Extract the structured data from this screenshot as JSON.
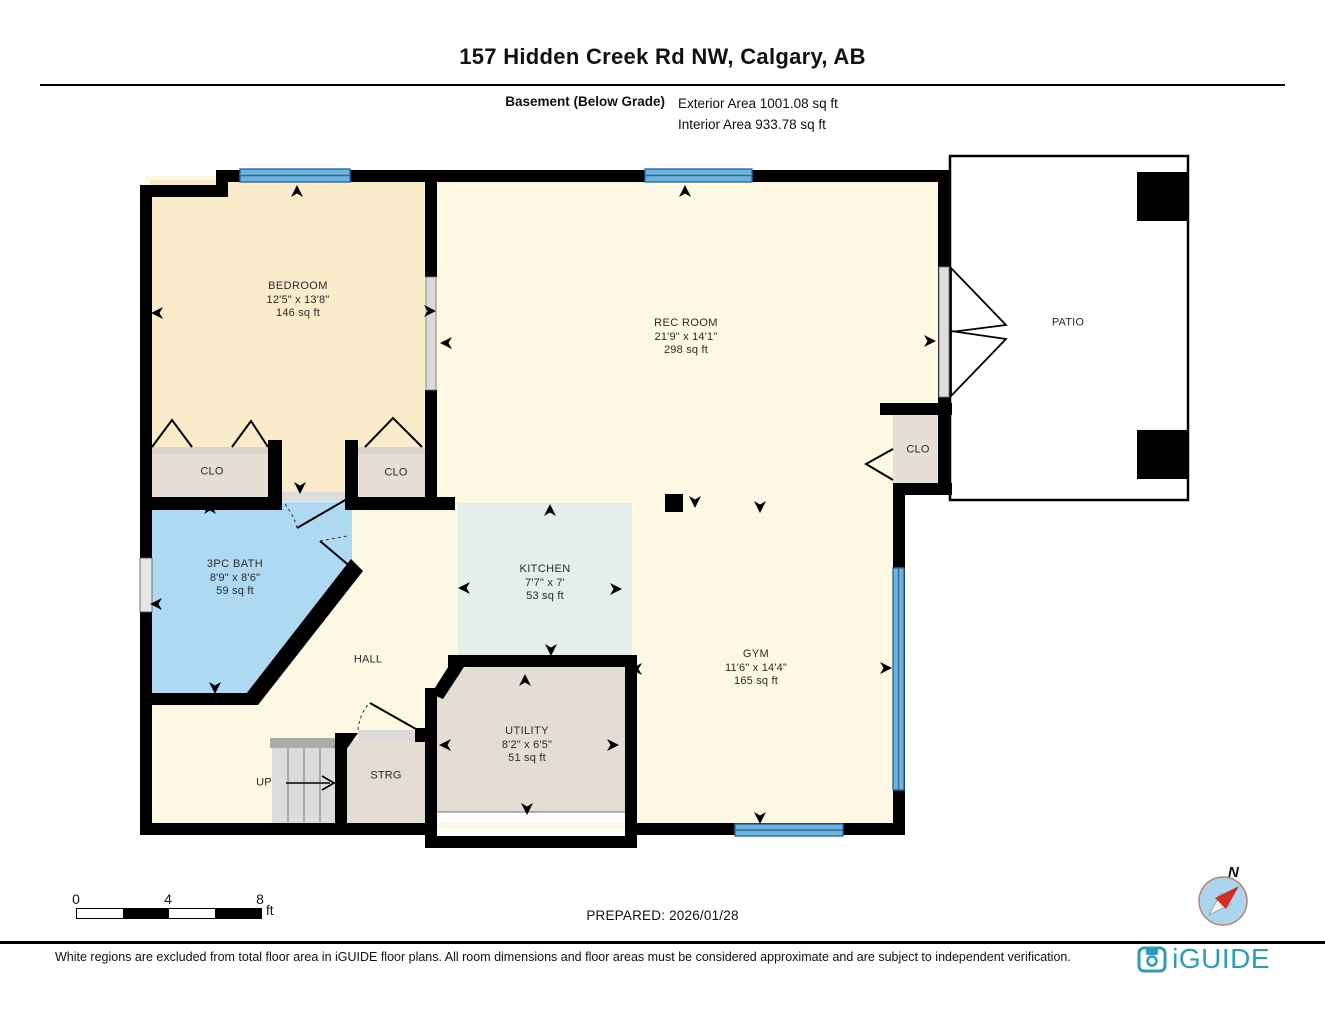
{
  "header": {
    "title": "157 Hidden Creek Rd NW, Calgary, AB",
    "floor_label": "Basement (Below Grade)",
    "exterior_area": "Exterior Area 1001.08 sq ft",
    "interior_area": "Interior Area 933.78 sq ft"
  },
  "rooms": {
    "bedroom": {
      "name": "BEDROOM",
      "dims": "12'5\" x 13'8\"",
      "area": "146 sq ft"
    },
    "rec_room": {
      "name": "REC ROOM",
      "dims": "21'9\" x 14'1\"",
      "area": "298 sq ft"
    },
    "bath": {
      "name": "3PC BATH",
      "dims": "8'9\" x 8'6\"",
      "area": "59 sq ft"
    },
    "kitchen": {
      "name": "KITCHEN",
      "dims": "7'7\" x 7'",
      "area": "53 sq ft"
    },
    "gym": {
      "name": "GYM",
      "dims": "11'6\" x 14'4\"",
      "area": "165 sq ft"
    },
    "utility": {
      "name": "UTILITY",
      "dims": "8'2\" x 6'5\"",
      "area": "51 sq ft"
    },
    "hall": {
      "name": "HALL"
    },
    "storage": {
      "name": "STRG"
    },
    "stairs": {
      "name": "UP"
    },
    "patio": {
      "name": "PATIO"
    },
    "closet1": {
      "name": "CLO"
    },
    "closet2": {
      "name": "CLO"
    },
    "gym_closet": {
      "name": "CLO"
    }
  },
  "scale": {
    "t0": "0",
    "t4": "4",
    "t8": "8",
    "unit": "ft"
  },
  "prepared": "PREPARED: 2026/01/28",
  "compass": {
    "north": "N"
  },
  "footer": {
    "disclaimer": "White regions are excluded from total floor area in iGUIDE floor plans. All room dimensions and floor areas must be considered approximate and are subject to independent verification.",
    "brand": "iGUIDE"
  },
  "colors": {
    "wall": "#000000",
    "floor_main": "#FDF8E3",
    "floor_bedroom": "#FAEBCB",
    "bath_blue": "#AFD9F2",
    "kitchen_green": "#E4EFE9",
    "closet_taupe": "#E5DFD5",
    "stairs_gray": "#DCDCDC",
    "window_blue": "#6FB3DC",
    "window_edge": "#2B6C9B",
    "patio_white": "#FFFFFF",
    "brand_teal": "#2B9DB7",
    "compass_fill": "#ABD4EE",
    "compass_needle": "#D42B26"
  }
}
